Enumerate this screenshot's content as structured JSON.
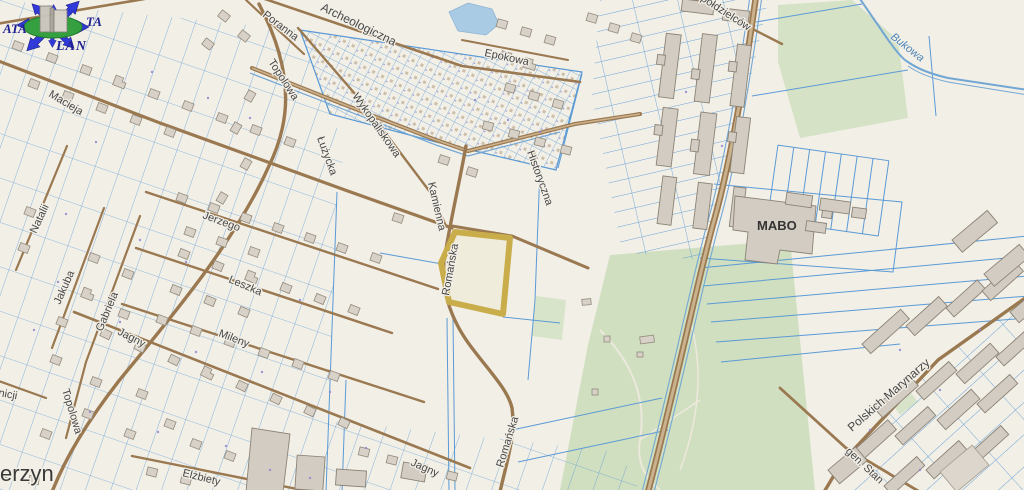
{
  "map": {
    "place_labels": [
      {
        "text": "erzyn"
      }
    ],
    "street_labels": [
      {
        "text": "Macieja"
      },
      {
        "text": "Natalii"
      },
      {
        "text": "Jakuba"
      },
      {
        "text": "Gabriela"
      },
      {
        "text": "Jerzego"
      },
      {
        "text": "Leszka"
      },
      {
        "text": "Mileny"
      },
      {
        "text": "Jagny"
      },
      {
        "text": "Jagny"
      },
      {
        "text": "Topolowa"
      },
      {
        "text": "Topolowa"
      },
      {
        "text": "Poranna"
      },
      {
        "text": "Archeologiczna"
      },
      {
        "text": "Wykopaliskowa"
      },
      {
        "text": "Łużycka"
      },
      {
        "text": "Kamienna"
      },
      {
        "text": "Historyczna"
      },
      {
        "text": "Epokowa"
      },
      {
        "text": "Spółdzielców"
      },
      {
        "text": "Romańska"
      },
      {
        "text": "Romańska"
      },
      {
        "text": "Elżbiety"
      },
      {
        "text": "Polskich Marynarzy"
      },
      {
        "text": "gen. Stan"
      },
      {
        "text": "nicji"
      }
    ],
    "area_labels": [
      {
        "text": "MABO"
      }
    ],
    "water_labels": [
      {
        "text": "Bukowa"
      }
    ],
    "colors": {
      "background": "#f2efe7",
      "parcel_line": "#5b9ad5",
      "road": "#9a7850",
      "highlight": "#c9ad4b",
      "green_area": "#d5e2c6",
      "water": "#a9cbe4",
      "building": "#d8d1c7"
    }
  },
  "logo": {
    "left": "ATA",
    "right": "TA",
    "bottom": "LAN"
  }
}
